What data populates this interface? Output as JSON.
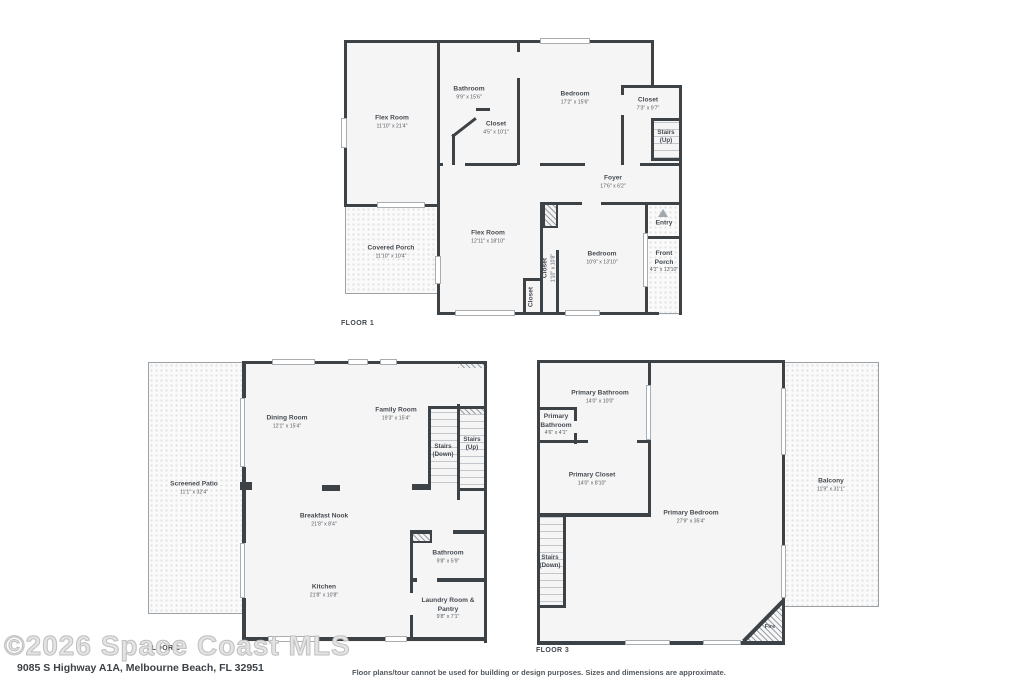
{
  "page": {
    "watermark": "©2026 Space Coast MLS",
    "address": "9085 S Highway A1A, Melbourne Beach, FL 32951",
    "disclaimer": "Floor plans/tour cannot be used for building or design purposes. Sizes and dimensions are approximate."
  },
  "colors": {
    "wall": "#3d4247",
    "room_fill": "#f5f5f6",
    "text": "#474c52",
    "watermark": "#c7c7c7"
  },
  "icons": {
    "entry_arrow": "triangle-up"
  },
  "floors": [
    {
      "label": "FLOOR 1",
      "rooms": [
        {
          "name": "Flex Room",
          "dims": "11'10\" x 21'4\""
        },
        {
          "name": "Bathroom",
          "dims": "9'9\" x 15'6\""
        },
        {
          "name": "Closet",
          "dims": "4'5\" x 10'1\""
        },
        {
          "name": "Bedroom",
          "dims": "17'2\" x 15'6\""
        },
        {
          "name": "Closet",
          "dims": "7'3\" x 9'7\""
        },
        {
          "name": "Stairs",
          "dims": "(Up)"
        },
        {
          "name": "Foyer",
          "dims": "17'6\" x 6'2\""
        },
        {
          "name": "Flex Room",
          "dims": "12'11\" x 18'10\""
        },
        {
          "name": "Covered Porch",
          "dims": "11'10\" x 10'4\""
        },
        {
          "name": "Closet",
          "dims": "1'10\" x 10'8\""
        },
        {
          "name": "Closet",
          "dims": ""
        },
        {
          "name": "Bedroom",
          "dims": "10'9\" x 13'10\""
        },
        {
          "name": "Entry",
          "dims": ""
        },
        {
          "name": "Front Porch",
          "dims": "4'1\" x 13'10\""
        }
      ]
    },
    {
      "label": "FLOOR 2",
      "rooms": [
        {
          "name": "Screened Patio",
          "dims": "11'1\" x 32'4\""
        },
        {
          "name": "Dining Room",
          "dims": "12'1\" x 15'4\""
        },
        {
          "name": "Family Room",
          "dims": "19'3\" x 15'4\""
        },
        {
          "name": "Stairs",
          "dims": "(Down)"
        },
        {
          "name": "Stairs",
          "dims": "(Up)"
        },
        {
          "name": "Breakfast Nook",
          "dims": "21'8\" x 8'4\""
        },
        {
          "name": "Kitchen",
          "dims": "21'8\" x 10'8\""
        },
        {
          "name": "Bathroom",
          "dims": "9'8\" x 5'9\""
        },
        {
          "name": "Laundry Room & Pantry",
          "dims": "9'8\" x 7'1\""
        }
      ]
    },
    {
      "label": "FLOOR 3",
      "rooms": [
        {
          "name": "Primary Bathroom",
          "dims": "14'0\" x 10'0\""
        },
        {
          "name": "Primary Bathroom",
          "dims": "4'6\" x 4'1\""
        },
        {
          "name": "Primary Closet",
          "dims": "14'0\" x 8'10\""
        },
        {
          "name": "Primary Bedroom",
          "dims": "27'9\" x 35'4\""
        },
        {
          "name": "Balcony",
          "dims": "11'9\" x 31'1\""
        },
        {
          "name": "Stairs",
          "dims": "(Down)"
        },
        {
          "name": "Fire",
          "dims": ""
        }
      ]
    }
  ]
}
